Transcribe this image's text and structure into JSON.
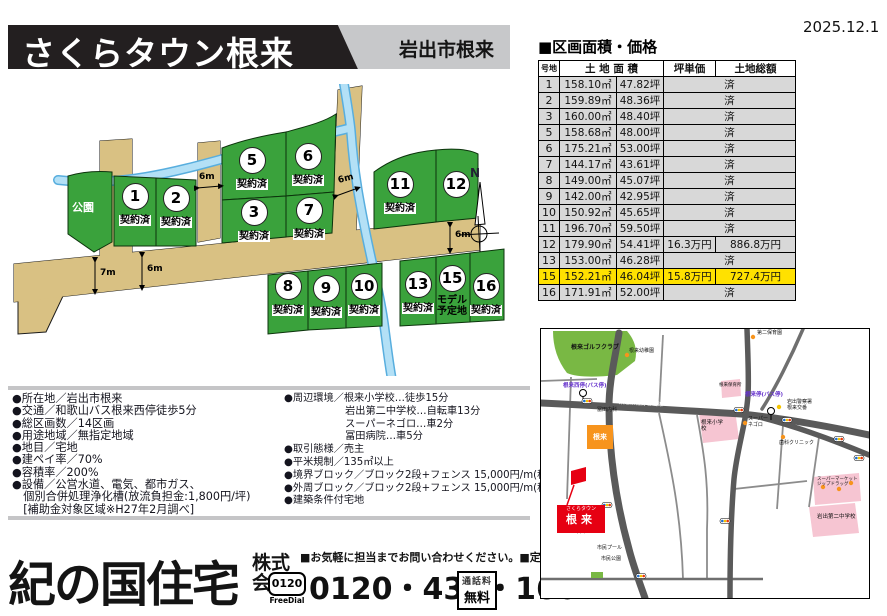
{
  "meta": {
    "date": "2025.12.1"
  },
  "header": {
    "title": "さくらタウン根来",
    "location": "岩出市根来"
  },
  "price_table": {
    "section_title": "■区画面積・価格",
    "columns": {
      "lot": "号地",
      "area": "土 地 面 積",
      "unit_price": "坪単価",
      "total": "土地総額"
    },
    "sold_label": "済",
    "rows": [
      {
        "lot": "1",
        "sqm": "158.10㎡",
        "tsubo": "47.82坪",
        "sold": true
      },
      {
        "lot": "2",
        "sqm": "159.89㎡",
        "tsubo": "48.36坪",
        "sold": true
      },
      {
        "lot": "3",
        "sqm": "160.00㎡",
        "tsubo": "48.40坪",
        "sold": true
      },
      {
        "lot": "5",
        "sqm": "158.68㎡",
        "tsubo": "48.00坪",
        "sold": true
      },
      {
        "lot": "6",
        "sqm": "175.21㎡",
        "tsubo": "53.00坪",
        "sold": true
      },
      {
        "lot": "7",
        "sqm": "144.17㎡",
        "tsubo": "43.61坪",
        "sold": true
      },
      {
        "lot": "8",
        "sqm": "149.00㎡",
        "tsubo": "45.07坪",
        "sold": true
      },
      {
        "lot": "9",
        "sqm": "142.00㎡",
        "tsubo": "42.95坪",
        "sold": true
      },
      {
        "lot": "10",
        "sqm": "150.92㎡",
        "tsubo": "45.65坪",
        "sold": true
      },
      {
        "lot": "11",
        "sqm": "196.70㎡",
        "tsubo": "59.50坪",
        "sold": true
      },
      {
        "lot": "12",
        "sqm": "179.90㎡",
        "tsubo": "54.41坪",
        "sold": false,
        "unit_price": "16.3万円",
        "total": "886.8万円",
        "highlight": false
      },
      {
        "lot": "13",
        "sqm": "153.00㎡",
        "tsubo": "46.28坪",
        "sold": true
      },
      {
        "lot": "15",
        "sqm": "152.21㎡",
        "tsubo": "46.04坪",
        "sold": false,
        "unit_price": "15.8万円",
        "total": "727.4万円",
        "highlight": true
      },
      {
        "lot": "16",
        "sqm": "171.91㎡",
        "tsubo": "52.00坪",
        "sold": true
      }
    ]
  },
  "site_plan": {
    "park_label": "公園",
    "compass_label": "N",
    "dim_6m": "6m",
    "dim_7m": "7m",
    "lots": [
      {
        "no": "1",
        "status": "契約済"
      },
      {
        "no": "2",
        "status": "契約済"
      },
      {
        "no": "3",
        "status": "契約済"
      },
      {
        "no": "5",
        "status": "契約済"
      },
      {
        "no": "6",
        "status": "契約済"
      },
      {
        "no": "7",
        "status": "契約済"
      },
      {
        "no": "8",
        "status": "契約済"
      },
      {
        "no": "9",
        "status": "契約済"
      },
      {
        "no": "10",
        "status": "契約済"
      },
      {
        "no": "11",
        "status": "契約済"
      },
      {
        "no": "12",
        "status": ""
      },
      {
        "no": "13",
        "status": "契約済"
      },
      {
        "no": "15",
        "status": "モデル\n予定地"
      },
      {
        "no": "16",
        "status": "契約済"
      }
    ]
  },
  "details": {
    "left": [
      "●所在地／岩出市根来",
      "●交通／和歌山バス根来西停徒歩5分",
      "●総区画数／14区画",
      "●用途地域／無指定地域",
      "●地目／宅地",
      "●建ペイ率／70%",
      "●容積率／200%",
      "●設備／公営水道、電気、都市ガス、",
      "　個別合併処理浄化槽(放流負担金:1,800円/坪)",
      "　[補助金対象区域※H27年2月調べ]"
    ],
    "right": [
      "●周辺環境／根来小学校…徒歩15分",
      "　　　　　　岩出第二中学校…自転車13分",
      "　　　　　　スーパーネゴロ…車2分",
      "　　　　　　冨田病院…車5分",
      "●取引態様／売主",
      "●平米規制／135㎡以上",
      "●境界ブロック／ブロック2段+フェンス 15,000円/m(税抜)",
      "●外周ブロック／ブロック2段+フェンス 15,000円/m(税抜)",
      "●建築条件付宅地"
    ]
  },
  "map": {
    "golf": "根来ゴルフクラブ",
    "road": "県道泉佐野岩出線",
    "bus_west": "根来西停(バス停)",
    "bus_main": "根来停(バス停)",
    "elementary": "根来小学校",
    "junior_high": "岩出第二中学校",
    "nursery": "根来保育所",
    "kindergarten": "根来幼稚園",
    "nursery2": "第二保育園",
    "supermarket": "スーパー\nネゴロ",
    "clinic_tomita": "冨田内科",
    "police": "岩出警察署\n根来交番",
    "dental": "歯科クリニック",
    "conbini": "根来",
    "site_line1": "さくらタウン",
    "site_line2": "根来",
    "pool": "市民プール",
    "civic_park": "市民公園",
    "nakanishi": "中西",
    "shopping": "スーパーマーケット\nジップドラッグ"
  },
  "footer": {
    "company": "紀の国住宅",
    "suffix1": "株式",
    "suffix2": "会社",
    "note": "■お気軽に担当までお問い合わせください。",
    "closed": "■定休日／水曜日",
    "freedial_num": "0120",
    "freedial_label": "FreeDial",
    "phone": "0120・433・160",
    "tollfree1": "通話料",
    "tollfree2": "無料"
  }
}
